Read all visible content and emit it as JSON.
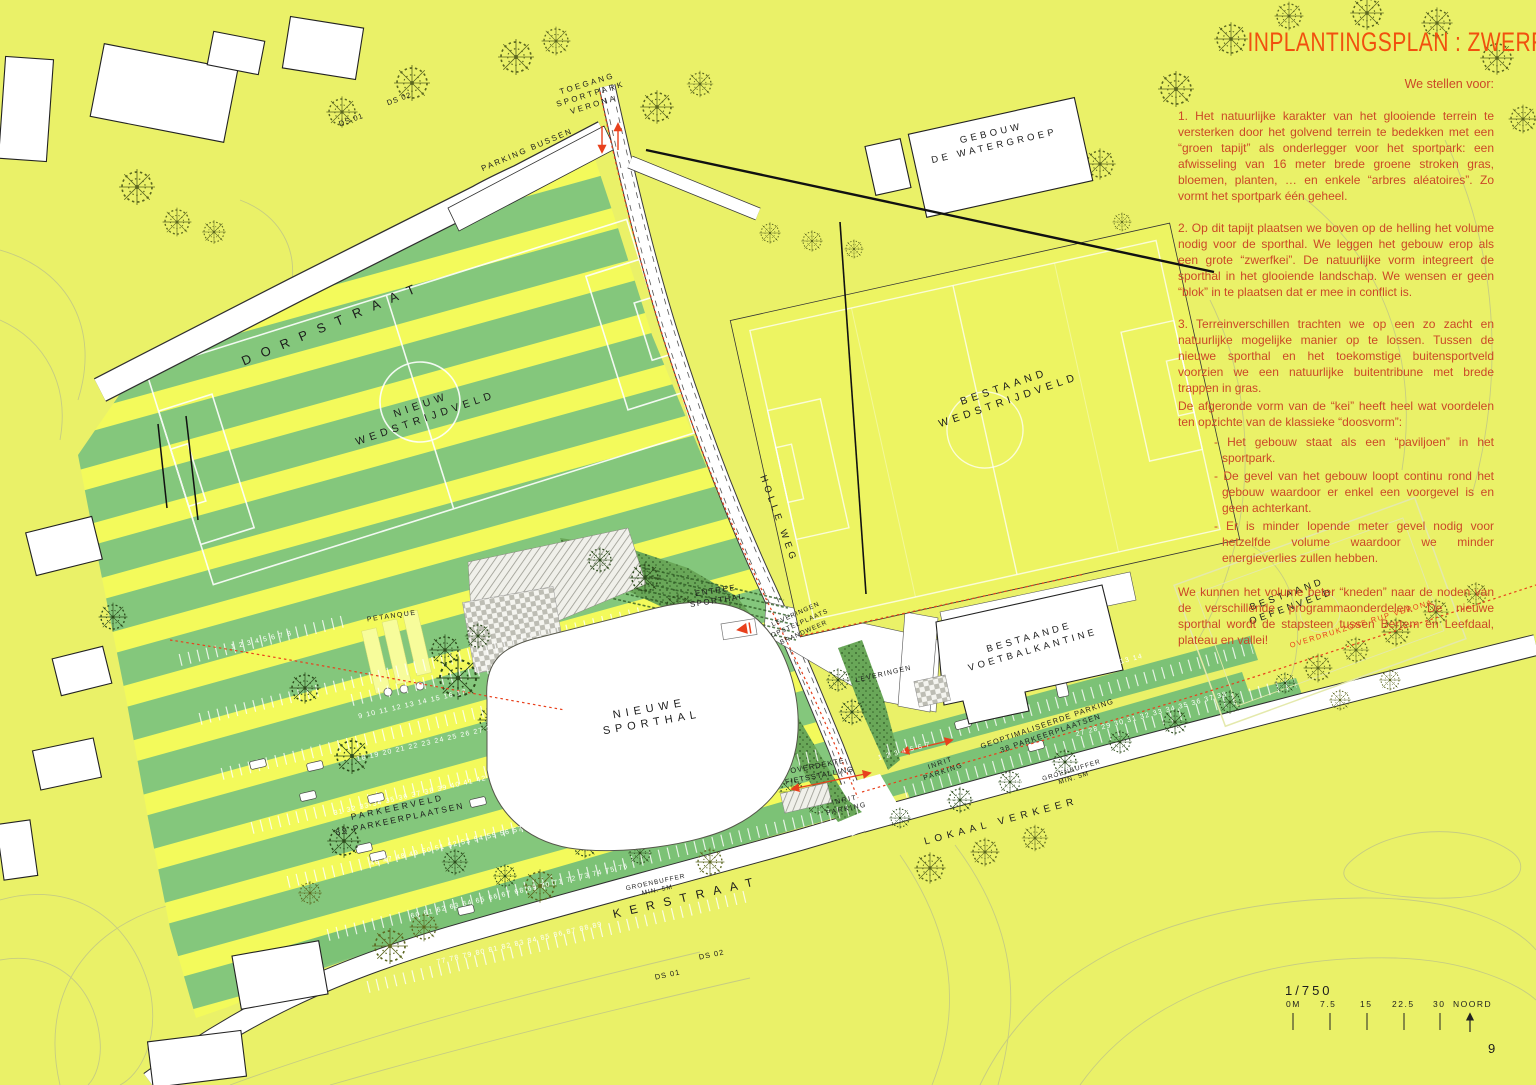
{
  "title": "INPLANTINGSPLAN : ZWERFKEI",
  "page": {
    "number": "9"
  },
  "proposal": {
    "intro": "We stellen voor:",
    "p1": "1. Het natuurlijke karakter van het glooiende terrein te versterken door het golvend terrein te bedekken met een “groen tapijt” als onderlegger voor het sportpark: een afwisseling van 16 meter brede groene stroken gras, bloemen, planten, … en enkele “arbres aléatoires”. Zo vormt het sportpark één geheel.",
    "p2": "2. Op dit tapijt plaatsen we boven op de helling het volume nodig voor de sporthal. We leggen het gebouw erop als een grote “zwerfkei”. De natuurlijke vorm integreert de sporthal in het glooiende landschap. We wensen er geen “blok” in te plaatsen dat er mee in conflict is.",
    "p3": "3. Terreinverschillen trachten we op een zo zacht en natuurlijke mogelijke manier op te lossen. Tussen de nieuwe sporthal en het toekomstige buitensportveld voorzien we een natuurlijke buitentribune met brede trappen in gras.",
    "p3b": "De afgeronde vorm van de “kei” heeft heel wat voordelen ten opzichte van de klassieke “doosvorm”:",
    "bullets": [
      "- Het gebouw staat als een “paviljoen” in het sportpark.",
      "- De gevel van het gebouw loopt continu rond het gebouw waardoor er enkel een voorgevel is en geen achterkant.",
      "- Er is minder lopende meter gevel nodig voor hetzelfde volume waardoor we minder energieverlies zullen hebben."
    ],
    "closing": "We kunnen het volume beter “kneden” naar de noden van de verschillende programmaonderdelen. De nieuwe sporthal wordt de stapsteen tussen Bertem en Leefdaal, plateau en vallei!"
  },
  "map": {
    "streets": {
      "dorpstraat": "DORPSTRAAT",
      "kerstraat": "KERSTRAAT",
      "holle_weg": "HOLLE WEG",
      "lokaal_verkeer": "LOKAAL VERKEER"
    },
    "labels": {
      "toegang_1": "TOEGANG",
      "toegang_2": "SPORTPARK",
      "toegang_3": "VERONA",
      "parking_bussen": "PARKING BUSSEN",
      "ds01": "DS 01",
      "ds02": "DS 02",
      "nieuw_veld_1": "NIEUW",
      "nieuw_veld_2": "WEDSTRIJDVELD",
      "bestaand_veld_1": "BESTAAND",
      "bestaand_veld_2": "WEDSTRIJDVELD",
      "watergroep_1": "GEBOUW",
      "watergroep_2": "DE WATERGROEP",
      "entree_1": "ENTREE",
      "entree_2": "SPORTHAL",
      "leveringen": "LEVERINGEN",
      "opstelplaats_1": "OPSTELPLAATS",
      "opstelplaats_2": "BRANDWEER",
      "sporthal_1": "NIEUWE",
      "sporthal_2": "SPORTHAL",
      "kantine_1": "BESTAANDE",
      "kantine_2": "VOETBALKANTINE",
      "oefenveld_1": "BESTAAND",
      "oefenveld_2": "OEFENVELD",
      "petanque": "PETANQUE",
      "parkeerveld_1": "PARKEERVELD",
      "parkeerveld_2": "89 PARKEERPLAATSEN",
      "fietsstalling_1": "OVERDEKTE",
      "fietsstalling_2": "FIETSSTALLING",
      "inrit_1": "INRIT",
      "inrit_2": "PARKING",
      "geopt_parking_1": "GEOPTIMALISEERDE PARKING",
      "geopt_parking_2": "38 PARKEERPLAATSEN",
      "groenbuffer_1": "GROENBUFFER",
      "groenbuffer_2": "MIN. 5M",
      "overdrukzone": "OVERDRUKZONE RUP VERONA"
    },
    "parking_numbers": {
      "west": [
        "1 2 3 4 5 6 7 8",
        "9 10 11 12 13 14 15 16 17",
        "18 19 20 21 22 23 24 25 26 27 28 29 30",
        "31 32 33 34 35 36 37 38 39 40 41 42 43 44 45",
        "46 47 48 49 50 51 52 53 54 55 56 57 58 59",
        "60 61 62 63 64 65 66 67 68 69 70 71 72 73 74 75 76",
        "77 78 79 80 81 82 83 84 85 86 87 88 89"
      ],
      "east": [
        "1 2 3 4 5 6 7",
        "8 9 10 11 12 13 14",
        "15 16 17 18 19 20 21 22 23 24 25 26",
        "27 28 29 30 31 32 33 34 35 36 37 38"
      ]
    },
    "scale": {
      "ratio": "1/750",
      "ticks": [
        "0M",
        "7.5",
        "15",
        "22.5",
        "30"
      ],
      "north": "NOORD"
    }
  },
  "colors": {
    "background": "#eaf168",
    "stripe_yellow": "#f3fa5b",
    "stripe_green": "#84c77c",
    "buffer_green": "#7cc276",
    "accent_red": "#e8401c",
    "text_red": "#cb4827",
    "title_red": "#f1500e"
  }
}
